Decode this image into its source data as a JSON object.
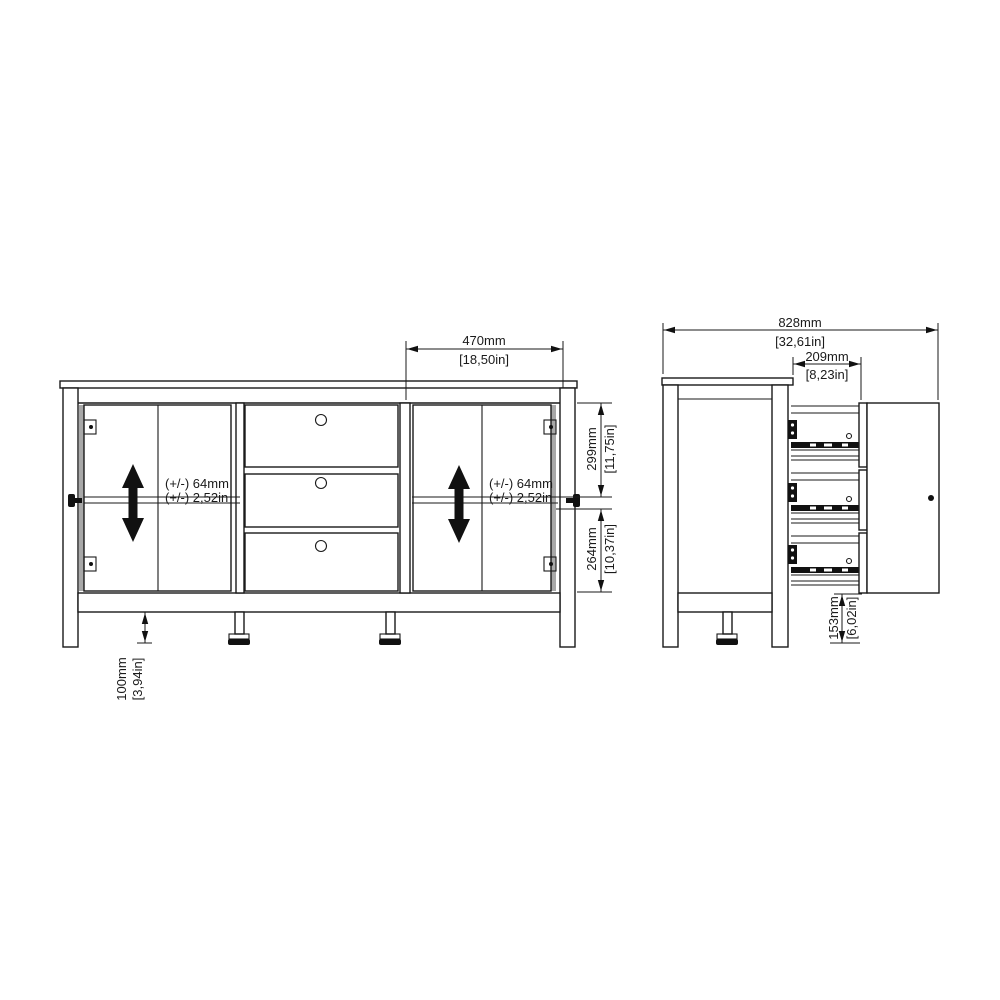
{
  "front_view": {
    "door_width": {
      "mm": "470mm",
      "inches": "[18,50in]"
    },
    "upper_height": {
      "mm": "299mm",
      "inches": "[11,75in]"
    },
    "lower_height": {
      "mm": "264mm",
      "inches": "[10,37in]"
    },
    "leg_height": {
      "mm": "100mm",
      "inches": "[3,94in]"
    },
    "shelf_left": {
      "line1": "(+/-) 64mm",
      "line2": "(+/-) 2,52in"
    },
    "shelf_right": {
      "line1": "(+/-) 64mm",
      "line2": "(+/-) 2,52in"
    }
  },
  "side_view": {
    "total_depth": {
      "mm": "828mm",
      "inches": "[32,61in]"
    },
    "drawer_extension": {
      "mm": "209mm",
      "inches": "[8,23in]"
    },
    "bottom_clearance": {
      "mm": "153mm",
      "inches": "[6,02in]"
    }
  },
  "colors": {
    "line": "#1a1a1a",
    "background": "#ffffff",
    "arrow": "#000000"
  }
}
